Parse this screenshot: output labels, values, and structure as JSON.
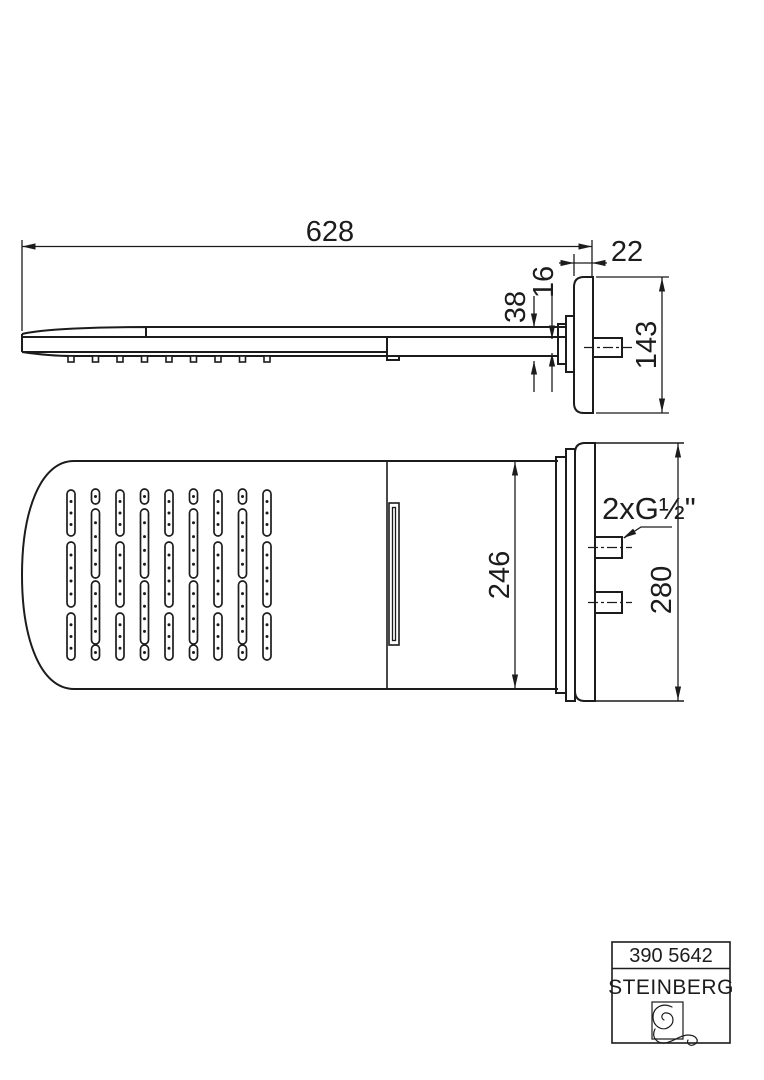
{
  "colors": {
    "line": "#1c1c1c",
    "background": "#ffffff"
  },
  "side_view": {
    "description": "side elevation of overhead rain shower panel with wall plate",
    "dim_length": "628",
    "dim_wall_offset": "22",
    "dim_panel_thickness": "16",
    "dim_head_thickness": "38",
    "dim_plate_height": "143"
  },
  "plan_view": {
    "description": "underside plan view of shower head with nozzle slots and wall plate",
    "dim_body_width": "246",
    "dim_plate_width": "280",
    "connection_label": "2xG½\""
  },
  "title_block": {
    "article_number": "390 5642",
    "brand": "STEINBERG",
    "logo_icon": "steinberg-swirl"
  }
}
